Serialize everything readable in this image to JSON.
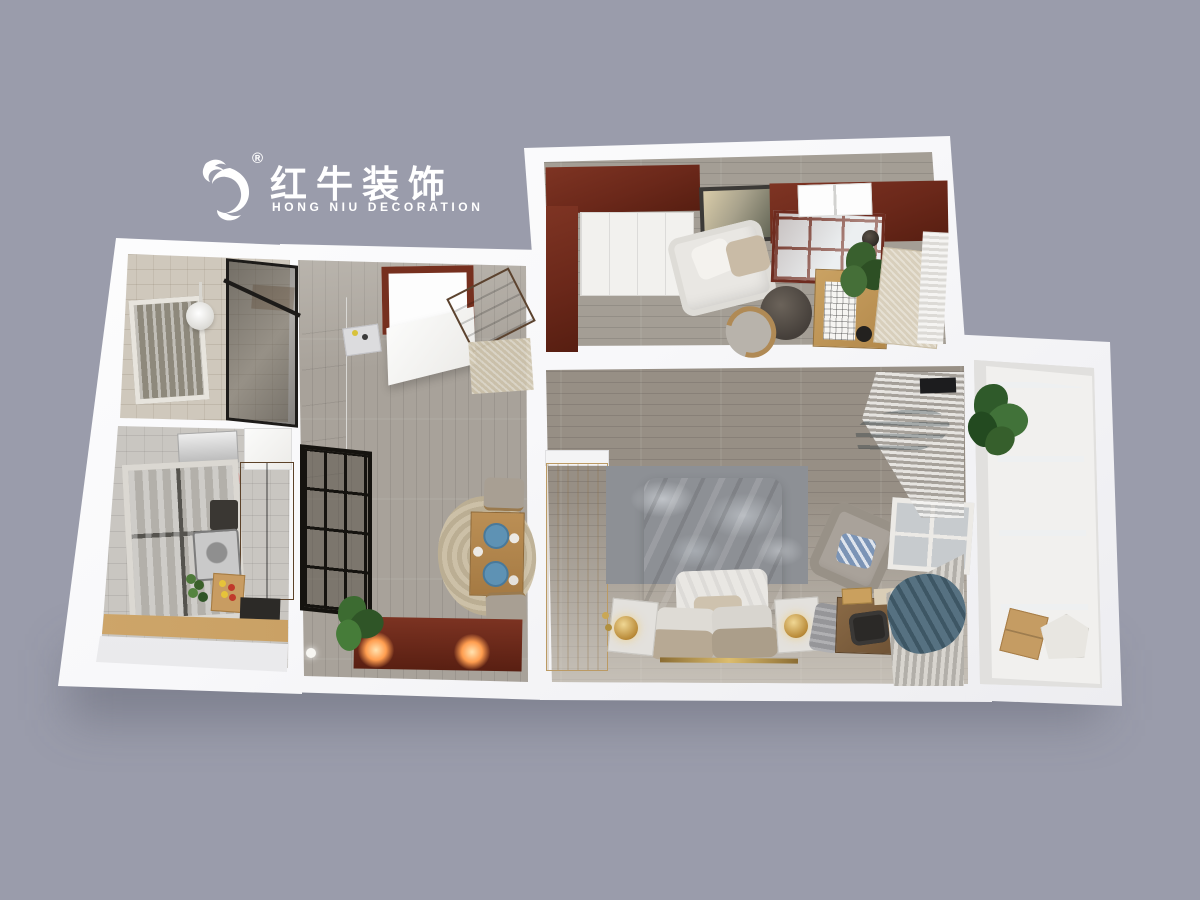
{
  "scene": {
    "type": "3d-floorplan-dollhouse-render",
    "description": "Top-down 3D rendering of a furnished one-bedroom apartment floor plan on a plain grey backdrop",
    "background_color": "#9a9cab"
  },
  "logo": {
    "icon": "bull-logo-icon",
    "registered_mark": "®",
    "brand_cn": "红牛装饰",
    "brand_en": "HONG NIU DECORATION",
    "color": "#ffffff"
  },
  "palette": {
    "wall_white": "#f7f7f9",
    "mahogany": "#6e2b1f",
    "light_wood": "#dcc08f",
    "oak": "#c19a5f",
    "walnut": "#7a5636",
    "grey_wood_floor": "#978f85",
    "beige_tile": "#cfc8bc",
    "grey_tile": "#c9c6c1",
    "teal_curtain": "#567181",
    "blue_plate": "#5e92b4",
    "lamp_glow": "#ff9d4f",
    "gold": "#c2a05c",
    "plant_green": "#3c6b31"
  },
  "rooms": [
    {
      "name": "study",
      "items": [
        "mahogany-cabinets",
        "white-wardrobe",
        "framed-artwork",
        "white-sofa",
        "throw-pillows",
        "round-ottoman",
        "wood-chair",
        "glass-door-bookcase",
        "white-storage-cubes",
        "writing-desk",
        "grid-chart-sheet",
        "desk-plant",
        "sphere-lamp",
        "beige-rug",
        "sheer-curtain"
      ]
    },
    {
      "name": "bathroom",
      "items": [
        "window-blind",
        "ceiling-light",
        "shower-head",
        "glass-shower-screen",
        "wall-shelf"
      ]
    },
    {
      "name": "kitchen",
      "items": [
        "water-heater",
        "hanging-wok",
        "upper-cabinet",
        "window",
        "tall-wood-cabinet",
        "sink",
        "stove",
        "cutting-board-with-fruit",
        "vegetables",
        "dark-appliance",
        "wood-countertop",
        "base-cabinets"
      ]
    },
    {
      "name": "dining-hall",
      "items": [
        "entry-door-mahogany-frame",
        "open-wood-door",
        "doormat",
        "angled-shoe-cabinet",
        "wall-cabinets",
        "utility-counter",
        "black-grid-glass-partition",
        "round-jute-rug",
        "dining-table",
        "blue-plates",
        "bench-seats",
        "mahogany-sideboard",
        "lit-lamps",
        "potted-plant",
        "wall-sconce"
      ]
    },
    {
      "name": "master-bedroom",
      "items": [
        "light-wood-wardrobe",
        "textured-grey-rug",
        "double-bed",
        "duvet",
        "white-sheet",
        "pillows",
        "gold-foot-rail",
        "nightstands",
        "gold-table-lamps",
        "armchair",
        "blue-pattern-cushion",
        "grey-throw",
        "vanity-desk",
        "office-chair",
        "books",
        "window",
        "sheer-striped-curtains",
        "teal-curtain-swags",
        "curtain-rod-box"
      ]
    },
    {
      "name": "balcony",
      "items": [
        "floor-to-ceiling-grid-window",
        "hanging-plant",
        "cardboard-box",
        "white-tray"
      ]
    }
  ]
}
